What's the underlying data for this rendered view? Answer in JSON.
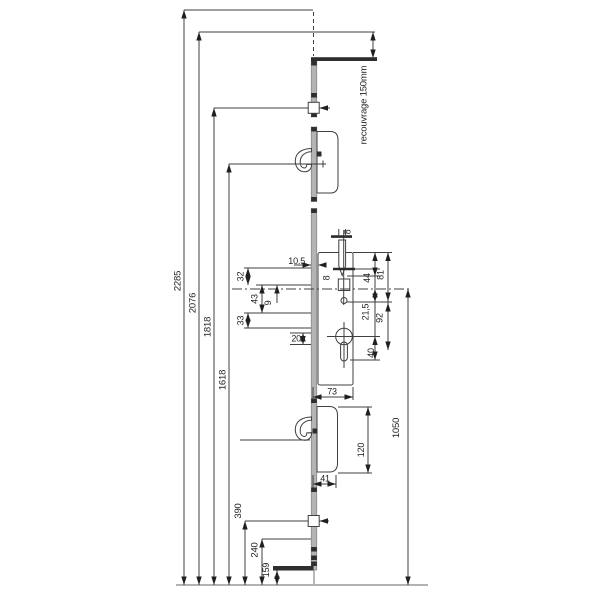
{
  "drawing": {
    "note_recouvrage": "recouvrage 150mm",
    "left_dimensions": {
      "total_height": "2285",
      "d2076": "2076",
      "d1818": "1818",
      "d1618": "1618",
      "d390": "390",
      "d240": "240",
      "d159": "159"
    },
    "gearbox_dimensions": {
      "latch_width": "8",
      "follower_width": "8",
      "faceplate_offset": "10.5",
      "s32": "32",
      "s43": "43",
      "s9": "9",
      "s33": "33",
      "s20": "20",
      "case_depth": "73",
      "r44": "44",
      "r81": "81",
      "r21_5": "21,5",
      "r92": "92",
      "r40": "40"
    },
    "hook_dimensions": {
      "case_height": "120",
      "case_width": "41"
    },
    "axis_to_bottom": "1050"
  }
}
